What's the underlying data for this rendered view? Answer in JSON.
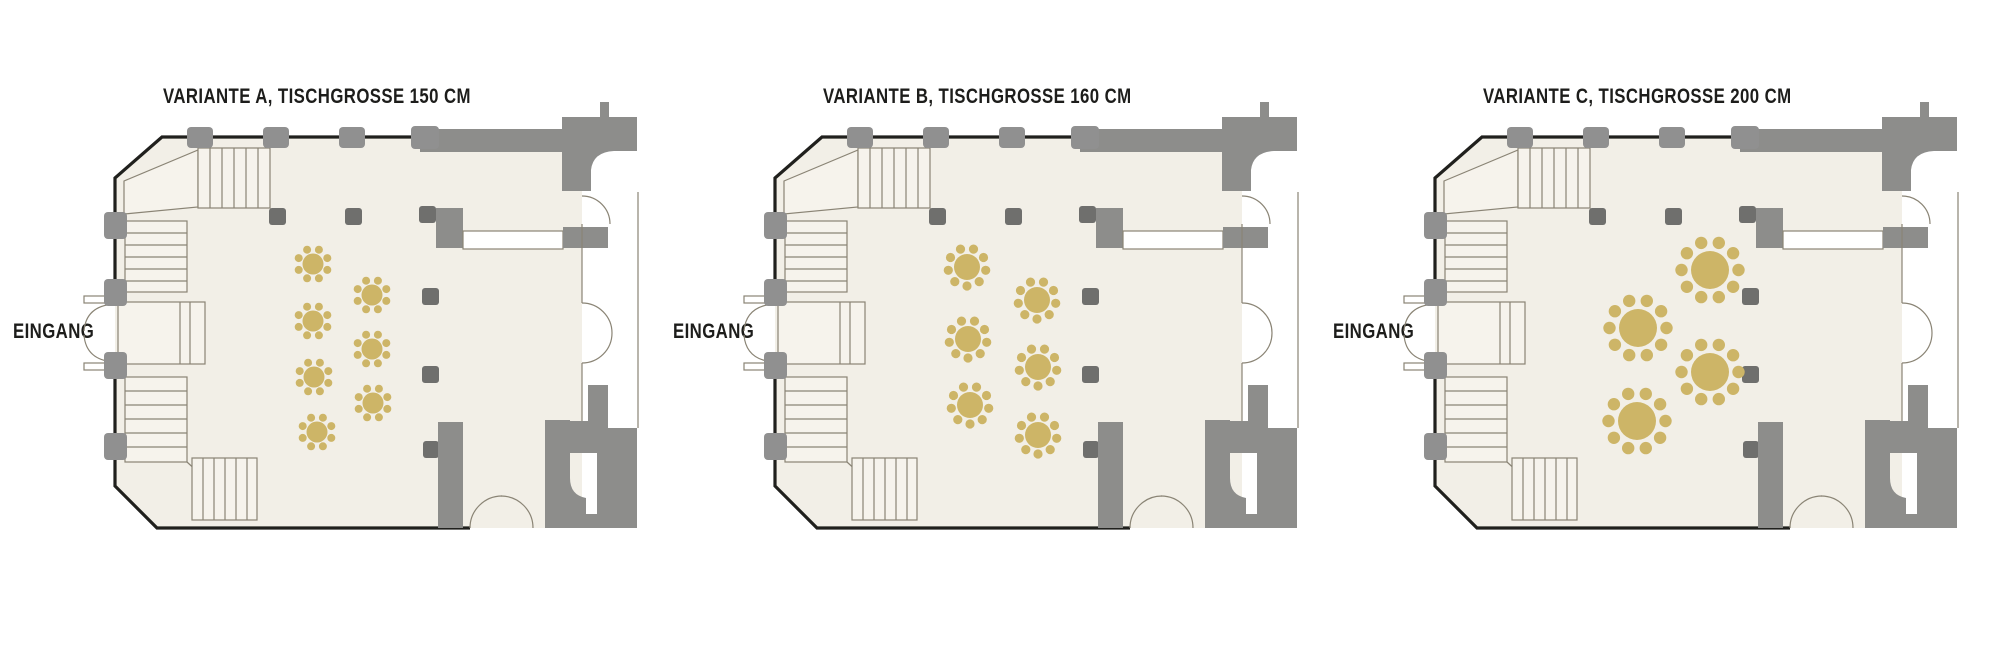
{
  "page": {
    "background": "#ffffff",
    "kind": "banquet floor plan variants"
  },
  "colors": {
    "background": "#ffffff",
    "floor": "#f2efe7",
    "stair_fill": "#f6f3ec",
    "thin_line": "#8a8475",
    "wall_black": "#20201d",
    "wall_gray": "#8d8d8b",
    "pillar_gray": "#909090",
    "pillar_dark": "#6f6f6d",
    "table_gold": "#cdb567",
    "text": "#1d1d1b"
  },
  "plans": [
    {
      "id": "variant-a",
      "title": "VARIANTE A, TISCHGROSSE 150 CM",
      "entrance_label": "EINGANG",
      "table_size_cm": 150,
      "table_count": 7,
      "seats_per_table": 8,
      "table_radius": 10.5,
      "chair_radius": 4.0,
      "chair_ring_radius": 15.5,
      "chair_start_angle_deg": -67.5,
      "tables": [
        {
          "x": 313,
          "y": 264
        },
        {
          "x": 313,
          "y": 321
        },
        {
          "x": 314,
          "y": 377
        },
        {
          "x": 317,
          "y": 432
        },
        {
          "x": 372,
          "y": 295
        },
        {
          "x": 372,
          "y": 349
        },
        {
          "x": 373,
          "y": 403
        }
      ]
    },
    {
      "id": "variant-b",
      "title": "VARIANTE B, TISCHGROSSE 160 CM",
      "entrance_label": "EINGANG",
      "table_size_cm": 160,
      "table_count": 6,
      "seats_per_table": 9,
      "table_radius": 13,
      "chair_radius": 4.6,
      "chair_ring_radius": 19,
      "chair_start_angle_deg": -70,
      "tables": [
        {
          "x": 307,
          "y": 267
        },
        {
          "x": 308,
          "y": 339
        },
        {
          "x": 310,
          "y": 405
        },
        {
          "x": 377,
          "y": 300
        },
        {
          "x": 378,
          "y": 367
        },
        {
          "x": 378,
          "y": 435
        }
      ]
    },
    {
      "id": "variant-c",
      "title": "VARIANTE C, TISCHGROSSE 200 CM",
      "entrance_label": "EINGANG",
      "table_size_cm": 200,
      "table_count": 4,
      "seats_per_table": 10,
      "table_radius": 19,
      "chair_radius": 6.2,
      "chair_ring_radius": 28.5,
      "chair_start_angle_deg": -72,
      "tables": [
        {
          "x": 390,
          "y": 270
        },
        {
          "x": 318,
          "y": 328
        },
        {
          "x": 390,
          "y": 372
        },
        {
          "x": 317,
          "y": 421
        }
      ]
    }
  ]
}
